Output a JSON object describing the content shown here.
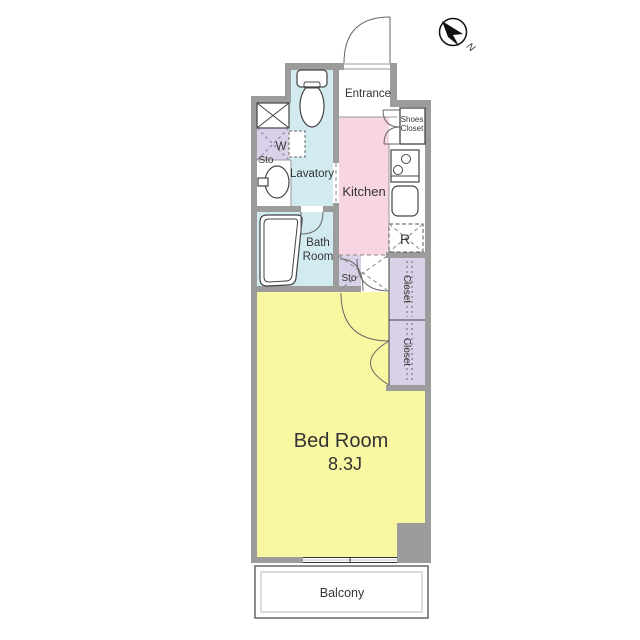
{
  "colors": {
    "wall": "#9c9c9c",
    "water": "#d2ebf1",
    "kitchen": "#f7d5e2",
    "bedroom": "#f9f7a2",
    "closet": "#d8d1e7",
    "white": "#ffffff",
    "door_line": "#666666",
    "outline": "#444444",
    "text": "#333333"
  },
  "compass": {
    "north_label": "N"
  },
  "rooms": {
    "entrance": {
      "label": "Entrance"
    },
    "shoes_closet": {
      "line1": "Shoes",
      "line2": "Closet"
    },
    "kitchen": {
      "label": "Kitchen"
    },
    "lavatory": {
      "label": "Lavatory"
    },
    "washer_storage": {
      "label_w": "W",
      "label_sto": "Sto"
    },
    "bath": {
      "line1": "Bath",
      "line2": "Room"
    },
    "storage": {
      "label": "Sto"
    },
    "refrigerator_space": {
      "label": "R"
    },
    "closet_upper": {
      "label": "Closet"
    },
    "closet_lower": {
      "label": "Closet"
    },
    "bedroom": {
      "label": "Bed Room",
      "size": "8.3J"
    },
    "balcony": {
      "label": "Balcony"
    }
  }
}
